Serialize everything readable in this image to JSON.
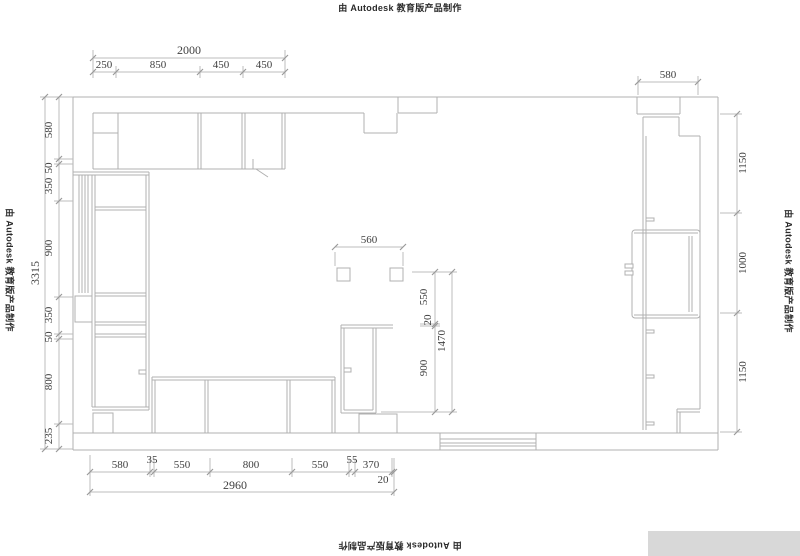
{
  "watermark": {
    "text": "由 Autodesk 教育版产品制作"
  },
  "dims": {
    "top": {
      "total": "2000",
      "parts": [
        "250",
        "850",
        "450",
        "450"
      ]
    },
    "top_right": {
      "width": "580"
    },
    "left": {
      "total": "3315",
      "parts": [
        "580",
        "50",
        "350",
        "900",
        "350",
        "50",
        "800",
        "235"
      ]
    },
    "right": {
      "parts": [
        "1150",
        "1000",
        "1150"
      ]
    },
    "island": {
      "width": "560",
      "total": "1470",
      "parts": [
        "550",
        "20",
        "900"
      ]
    },
    "bottom": {
      "total": "2960",
      "parts": [
        "580",
        "35",
        "550",
        "800",
        "550",
        "55",
        "370",
        "20"
      ]
    }
  }
}
